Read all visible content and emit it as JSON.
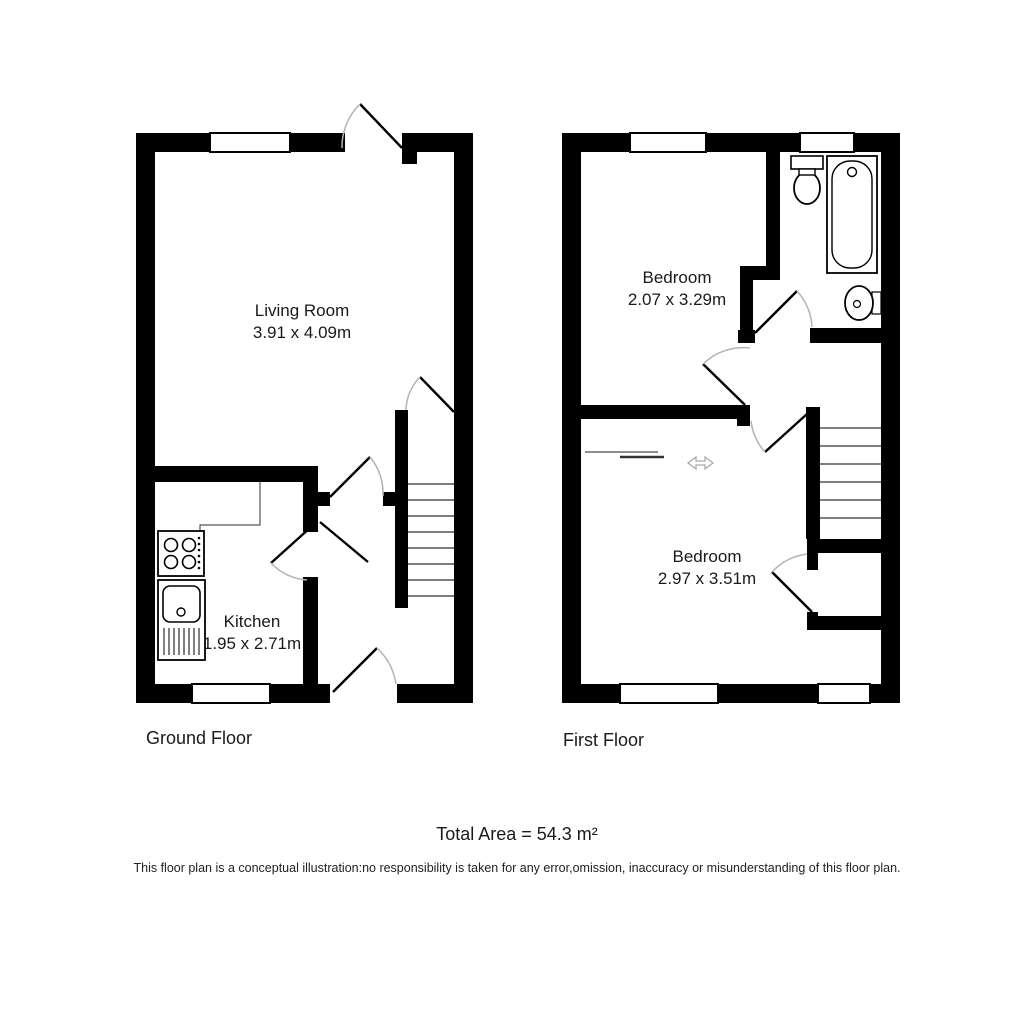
{
  "ground_floor": {
    "label": "Ground Floor",
    "rooms": {
      "living_room": {
        "name": "Living Room",
        "dimensions": "3.91 x 4.09m"
      },
      "kitchen": {
        "name": "Kitchen",
        "dimensions": "1.95 x 2.71m"
      }
    }
  },
  "first_floor": {
    "label": "First Floor",
    "rooms": {
      "bedroom_1": {
        "name": "Bedroom",
        "dimensions": "2.07 x 3.29m"
      },
      "bedroom_2": {
        "name": "Bedroom",
        "dimensions": "2.97 x 3.51m"
      }
    }
  },
  "summary": {
    "total_area": "Total Area = 54.3 m²"
  },
  "disclaimer": "This floor plan is a conceptual illustration:no responsibility is taken for any error,omission, inaccuracy or misunderstanding of this floor plan.",
  "colors": {
    "wall": "#000000",
    "background": "#ffffff",
    "door_arc": "#b3b3b3",
    "text": "#1a1a1a"
  }
}
